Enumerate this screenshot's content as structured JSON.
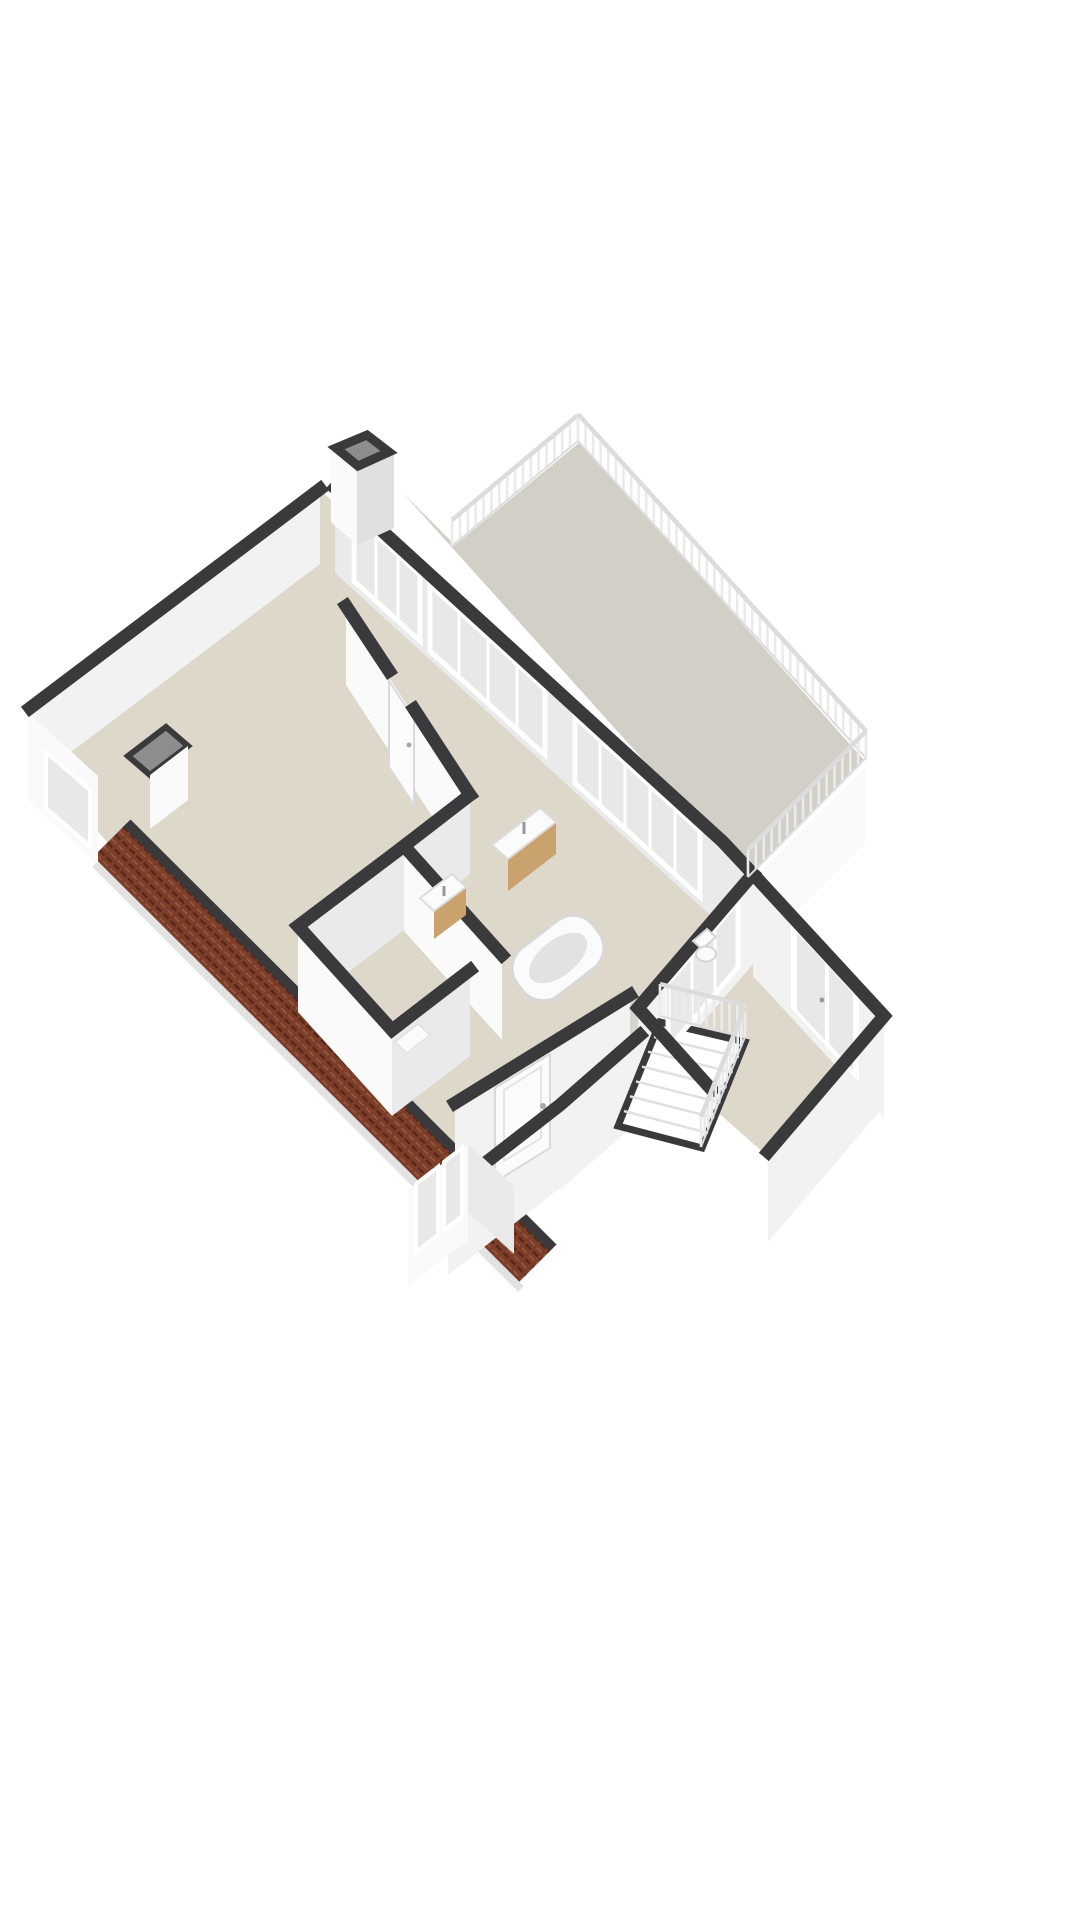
{
  "scene": {
    "type": "isometric-3d-floorplan",
    "description": "3D cutaway floor plan of an upper storey: large landing room, bathroom with tub and twin basins, toilet, bedrooms, stairwell with banister, roof terrace with balustrade, chimney, and pitched tiled roof along the lower-left edge",
    "background": "#ffffff"
  },
  "colors": {
    "wall_top": "#3a3a3c",
    "face_bright": "#fafafb",
    "face_light": "#f2f2f3",
    "face_shade": "#eaeaec",
    "face_dark": "#e0e0e2",
    "floor_room": "#ddd8ca",
    "floor_hall": "#d6d4cc",
    "floor_terrace": "#d2cfc6",
    "glass": "#e7e9e6",
    "frame": "#ffffff",
    "roof_base": "#7c3e29",
    "roof_line": "#58291a",
    "roof_hi": "#9a5a40",
    "eave": "#3a3a3c",
    "fascia": "#e2e2e2",
    "railing_rail": "#dcdcdc",
    "railing_post": "#ebebeb",
    "wood": "#c9a26d",
    "fixture": "#fbfbfb",
    "fixture_shade": "#d9d9d9",
    "chimney_inner": "#8d8d8f",
    "step_edge": "#e0e0e0"
  },
  "railings": [
    {
      "name": "terrace-railing-nw",
      "x1": 452,
      "y1": 546,
      "x2": 578,
      "y2": 441,
      "h": 26,
      "n": 16
    },
    {
      "name": "terrace-railing-ne",
      "x1": 578,
      "y1": 441,
      "x2": 866,
      "y2": 758,
      "h": 27,
      "n": 38
    },
    {
      "name": "terrace-railing-se",
      "x1": 866,
      "y1": 758,
      "x2": 748,
      "y2": 877,
      "h": 27,
      "n": 15
    },
    {
      "name": "stair-banister-top",
      "x1": 660,
      "y1": 1016,
      "x2": 745,
      "y2": 1037,
      "h": 32,
      "n": 11
    },
    {
      "name": "stair-banister-side",
      "x1": 745,
      "y1": 1037,
      "x2": 701,
      "y2": 1147,
      "h": 30,
      "n": 12
    }
  ],
  "roof": {
    "inner": [
      127,
      823,
      553,
      1248
    ],
    "outer": [
      92,
      858,
      518,
      1283
    ],
    "courses": 9
  },
  "stairs": {
    "quad": [
      660,
      1022,
      745,
      1042,
      702,
      1148,
      618,
      1126
    ],
    "treads": 6
  }
}
